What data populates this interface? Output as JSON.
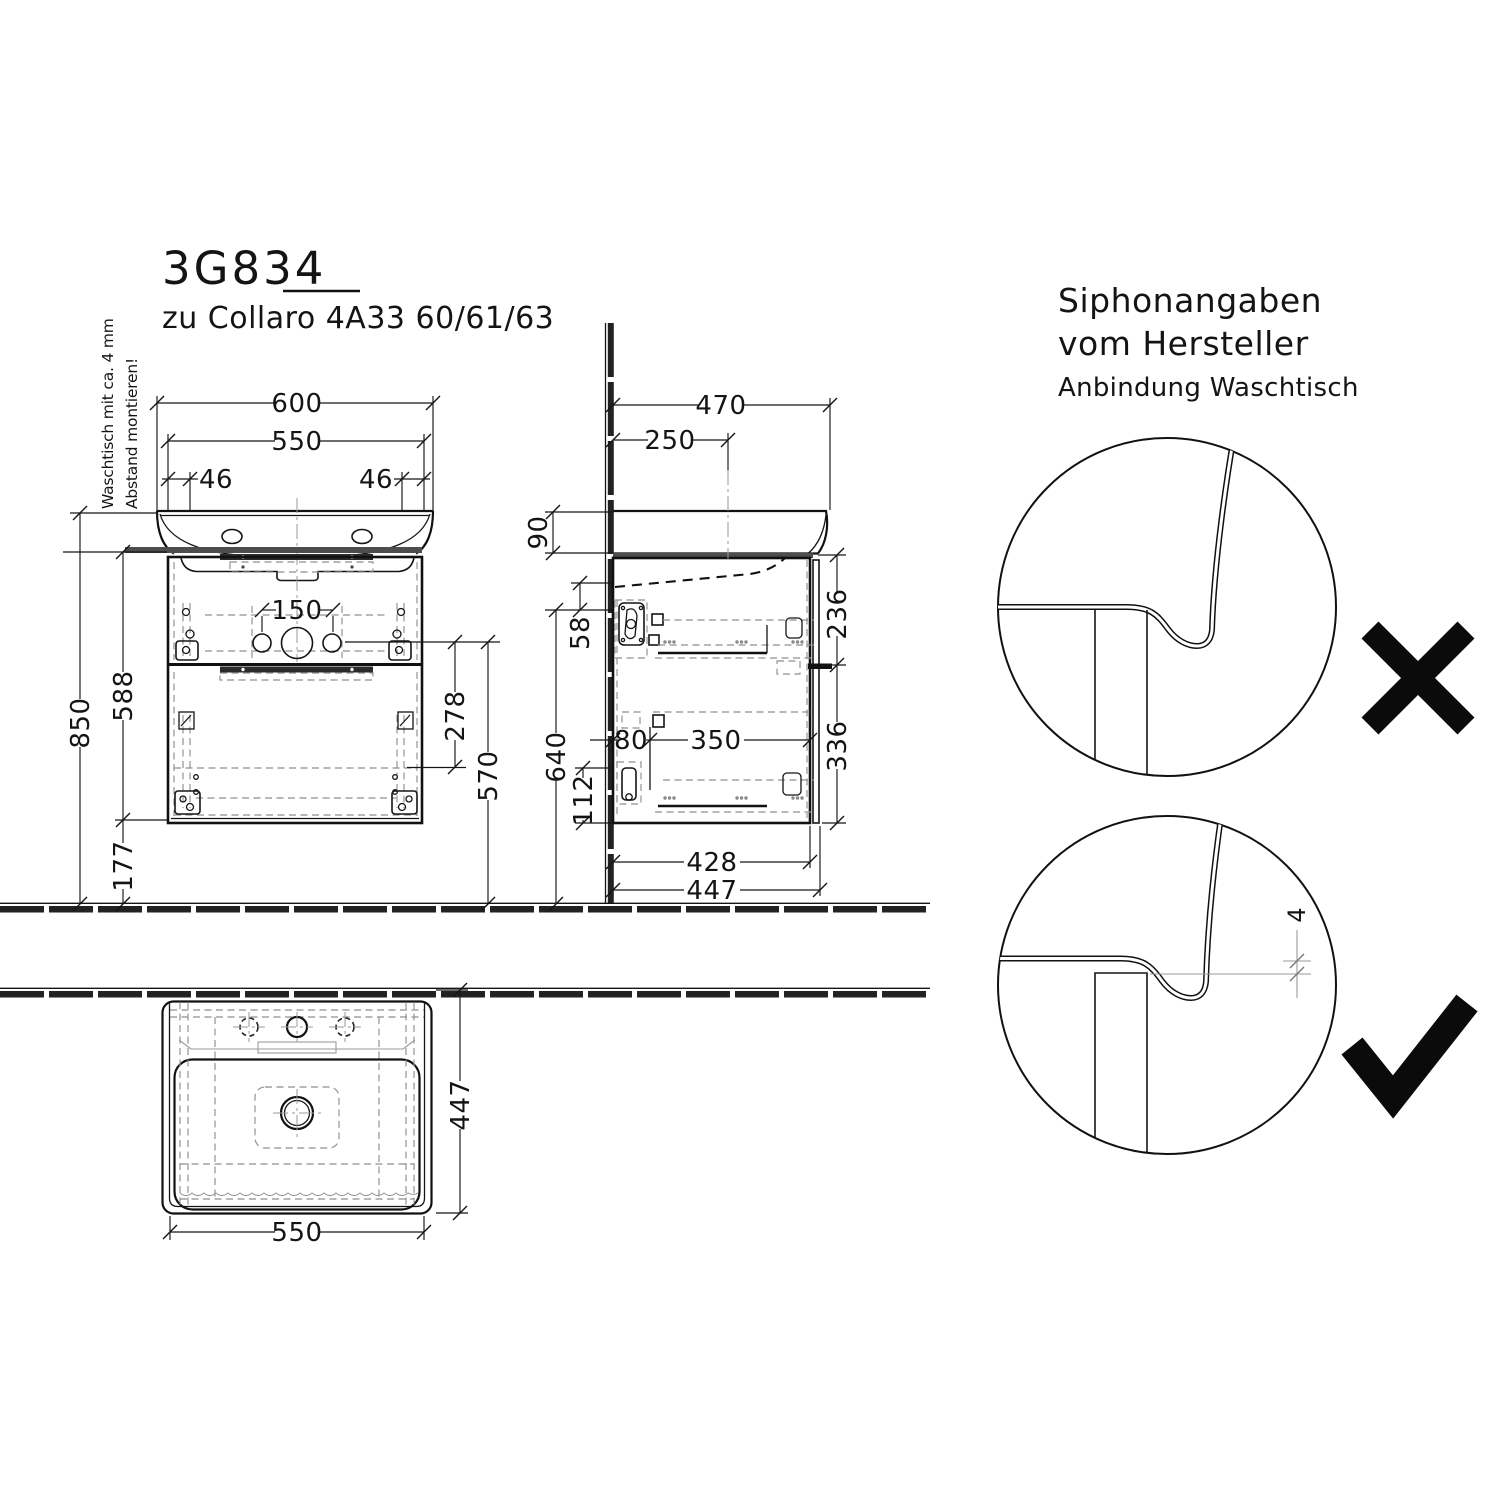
{
  "drawing": {
    "code": "3G834",
    "series": "zu Collaro 4A33 60/61/63",
    "mounting_note_line1": "Waschtisch mit ca. 4 mm",
    "mounting_note_line2": "Abstand montieren!"
  },
  "front_view": {
    "width_total": "600",
    "width_basin": "550",
    "offset_left": "46",
    "offset_right": "46",
    "faucet_span": "150",
    "height_total": "850",
    "height_cabinet": "588",
    "height_clearance": "177",
    "drain_to_bracket": "278",
    "drain_height": "570"
  },
  "side_view": {
    "depth_total": "470",
    "tap_distance": "250",
    "basin_rim": "90",
    "siphon_gap": "58",
    "outlet_height": "640",
    "slide_height": "112",
    "back_offset": "80",
    "slide_length": "350",
    "upper_drawer": "236",
    "lower_drawer": "336",
    "body_depth": "428",
    "overall_depth": "447"
  },
  "plan_view": {
    "depth": "447",
    "width": "550"
  },
  "siphon_detail": {
    "title_line1": "Siphonangaben",
    "title_line2": "vom Hersteller",
    "subtitle": "Anbindung Waschtisch",
    "clearance": "4"
  }
}
